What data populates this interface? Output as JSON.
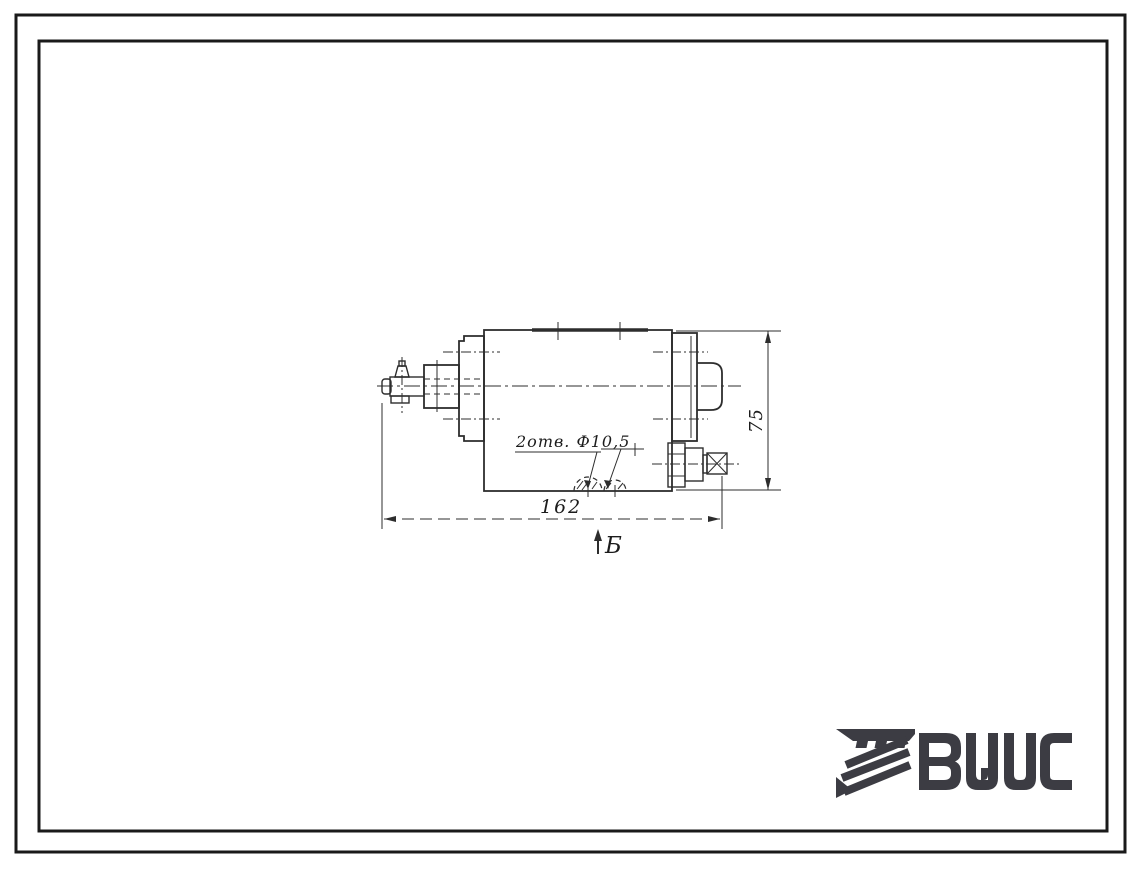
{
  "sheet": {
    "background": "#ffffff",
    "frame_color": "#1a1a1a"
  },
  "drawing": {
    "line_color": "#2d2d2d",
    "text_color": "#1c1c1c",
    "labels": {
      "holes_note": "2отв. Ф10,5",
      "length_dim": "162",
      "height_dim": "75",
      "section_letter": "Б"
    }
  },
  "logo": {
    "text": "ВЦИС",
    "color": "#3c3c43"
  }
}
